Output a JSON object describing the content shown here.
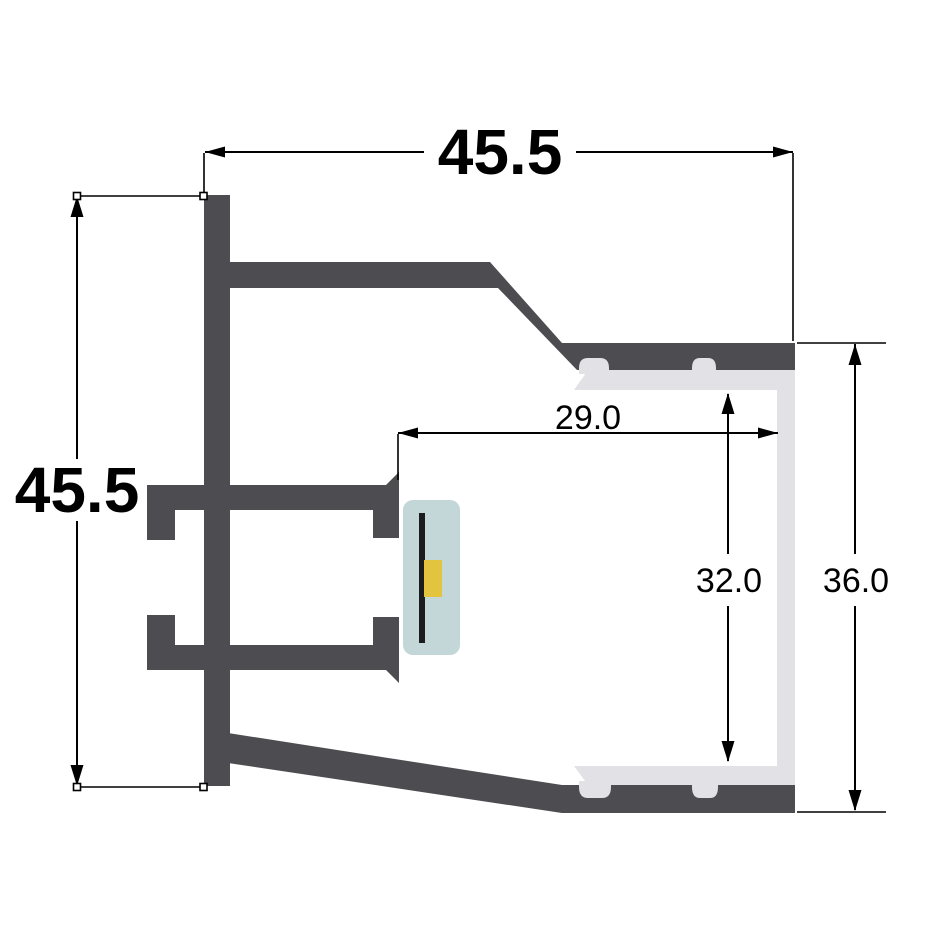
{
  "drawing": {
    "name": "led-aluminium-profile-cross-section",
    "dimensions": {
      "top_width": "45.5",
      "left_height": "45.5",
      "inner_width": "29.0",
      "inner_height": "32.0",
      "right_height": "36.0"
    },
    "colors": {
      "profile_dark": "#4d4d51",
      "diffuser_light": "#e2e2e6",
      "led_module_body": "#c3d6d8",
      "led_pcb_line": "#1c1c1e",
      "led_chip": "#e3c43e",
      "dimension_ink": "#000000",
      "background": "#ffffff"
    }
  }
}
